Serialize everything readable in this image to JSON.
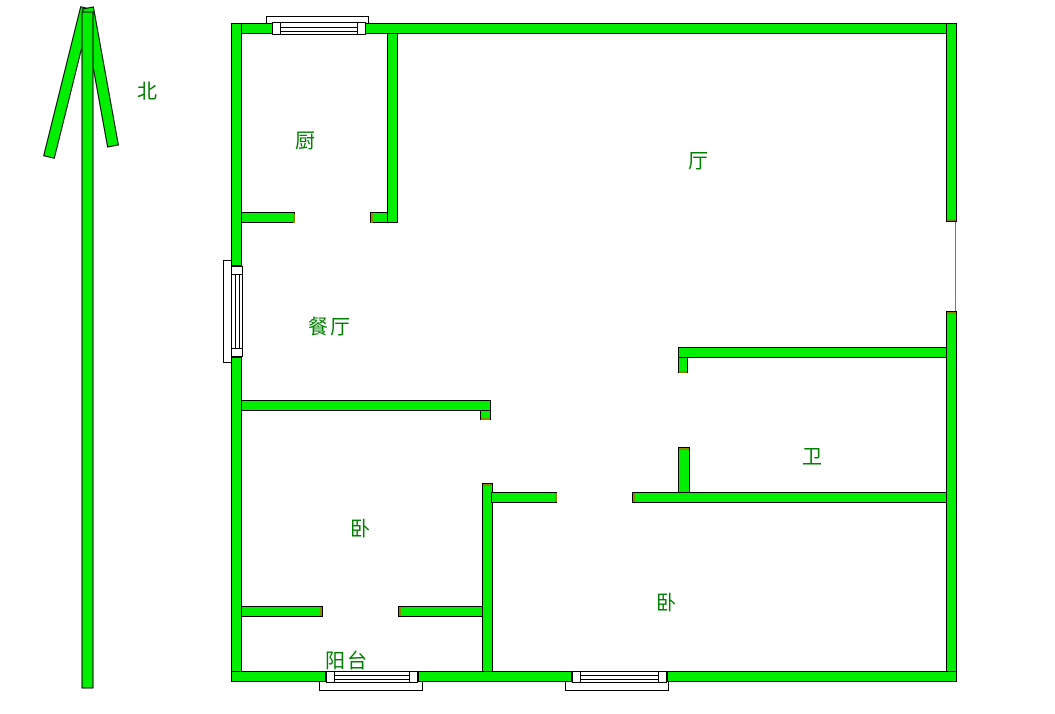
{
  "page": {
    "background": "#ffffff"
  },
  "colors": {
    "wall_fill": "#00ee00",
    "wall_outline": "#000000",
    "window_fill": "#ffffff",
    "window_outline": "#000000",
    "cut_end_accent": "#8a8a00",
    "label_color": "#008000"
  },
  "compass": {
    "label": "北"
  },
  "room_labels": [
    {
      "id": "kitchen",
      "text": "厨",
      "cx": 306,
      "cy": 139
    },
    {
      "id": "living-room",
      "text": "厅",
      "cx": 699,
      "cy": 159
    },
    {
      "id": "dining-room",
      "text": "餐厅",
      "cx": 330,
      "cy": 325
    },
    {
      "id": "bedroom-left",
      "text": "卧",
      "cx": 361,
      "cy": 527
    },
    {
      "id": "bathroom",
      "text": "卫",
      "cx": 813,
      "cy": 455
    },
    {
      "id": "bedroom-right",
      "text": "卧",
      "cx": 667,
      "cy": 601
    },
    {
      "id": "balcony",
      "text": "阳台",
      "cx": 347,
      "cy": 659
    }
  ],
  "walls": [
    {
      "id": "outer-top-west",
      "x": 231,
      "y": 23,
      "w": 42,
      "h": 11
    },
    {
      "id": "outer-top-main",
      "x": 365,
      "y": 23,
      "w": 592,
      "h": 11
    },
    {
      "id": "outer-left-upper",
      "x": 231,
      "y": 23,
      "w": 11,
      "h": 243
    },
    {
      "id": "outer-left-lower",
      "x": 231,
      "y": 357,
      "w": 11,
      "h": 325
    },
    {
      "id": "outer-right-upper",
      "x": 946,
      "y": 23,
      "w": 11,
      "h": 199
    },
    {
      "id": "outer-right-lower",
      "x": 946,
      "y": 311,
      "w": 11,
      "h": 371
    },
    {
      "id": "outer-bottom-west",
      "x": 231,
      "y": 671,
      "w": 95,
      "h": 11
    },
    {
      "id": "outer-bottom-mid",
      "x": 418,
      "y": 671,
      "w": 154,
      "h": 11
    },
    {
      "id": "outer-bottom-east",
      "x": 667,
      "y": 671,
      "w": 290,
      "h": 11
    },
    {
      "id": "kitchen-east",
      "x": 387,
      "y": 33,
      "w": 11,
      "h": 190
    },
    {
      "id": "kitchen-south-west",
      "x": 241,
      "y": 212,
      "w": 54,
      "h": 11
    },
    {
      "id": "kitchen-south-east",
      "x": 370,
      "y": 212,
      "w": 18,
      "h": 11
    },
    {
      "id": "bedroom-left-north",
      "x": 241,
      "y": 400,
      "w": 250,
      "h": 11
    },
    {
      "id": "bedroom-left-north-stub",
      "x": 480,
      "y": 410,
      "w": 11,
      "h": 10
    },
    {
      "id": "center-vertical",
      "x": 482,
      "y": 483,
      "w": 11,
      "h": 189
    },
    {
      "id": "corridor-west",
      "x": 491,
      "y": 492,
      "w": 66,
      "h": 11
    },
    {
      "id": "corridor-east",
      "x": 632,
      "y": 492,
      "w": 315,
      "h": 11
    },
    {
      "id": "bathroom-door-pier",
      "x": 678,
      "y": 447,
      "w": 12,
      "h": 46
    },
    {
      "id": "bathroom-north",
      "x": 678,
      "y": 347,
      "w": 269,
      "h": 11
    },
    {
      "id": "bathroom-north-stub",
      "x": 678,
      "y": 357,
      "w": 10,
      "h": 16
    },
    {
      "id": "bedroom-left-south-west",
      "x": 241,
      "y": 606,
      "w": 82,
      "h": 11
    },
    {
      "id": "bedroom-left-south-east",
      "x": 398,
      "y": 606,
      "w": 85,
      "h": 11
    }
  ],
  "cut_end_caps": [
    {
      "id": "cap-kitchen-south-end",
      "x": 293,
      "y": 214,
      "w": 2,
      "h": 9
    },
    {
      "id": "cap-kitchen-south-east",
      "x": 371,
      "y": 214,
      "w": 2,
      "h": 9
    },
    {
      "id": "cap-bed1-north-stub",
      "x": 481,
      "y": 418,
      "w": 9,
      "h": 2
    },
    {
      "id": "cap-center-vertical-top",
      "x": 483,
      "y": 484,
      "w": 9,
      "h": 2
    },
    {
      "id": "cap-corridor-west-end",
      "x": 555,
      "y": 493,
      "w": 2,
      "h": 9
    },
    {
      "id": "cap-corridor-east-start",
      "x": 633,
      "y": 493,
      "w": 2,
      "h": 9
    },
    {
      "id": "cap-bathroom-pier-top",
      "x": 679,
      "y": 448,
      "w": 10,
      "h": 2
    },
    {
      "id": "cap-bathroom-stub-bottom",
      "x": 679,
      "y": 371,
      "w": 8,
      "h": 2
    },
    {
      "id": "cap-right-wall-gap-top",
      "x": 947,
      "y": 219,
      "w": 9,
      "h": 2
    },
    {
      "id": "cap-right-wall-gap-bottom",
      "x": 947,
      "y": 312,
      "w": 9,
      "h": 2
    },
    {
      "id": "cap-bed1-south-west-end",
      "x": 320,
      "y": 607,
      "w": 2,
      "h": 9
    },
    {
      "id": "cap-bed1-south-east-start",
      "x": 399,
      "y": 607,
      "w": 2,
      "h": 9
    }
  ],
  "windows": {
    "rects": [
      {
        "id": "kitchen-window-sill",
        "x": 266,
        "y": 16,
        "w": 103,
        "h": 8
      },
      {
        "id": "kitchen-window-body",
        "x": 272,
        "y": 22,
        "w": 94,
        "h": 13
      },
      {
        "id": "left-window-sill",
        "x": 223,
        "y": 260,
        "w": 9,
        "h": 103
      },
      {
        "id": "left-window-body",
        "x": 231,
        "y": 266,
        "w": 12,
        "h": 91
      },
      {
        "id": "balcony-window-sill",
        "x": 319,
        "y": 681,
        "w": 104,
        "h": 10
      },
      {
        "id": "balcony-window-body",
        "x": 326,
        "y": 671,
        "w": 92,
        "h": 12
      },
      {
        "id": "bedroom-right-window-sill",
        "x": 565,
        "y": 681,
        "w": 104,
        "h": 10
      },
      {
        "id": "bedroom-right-window-body",
        "x": 572,
        "y": 671,
        "w": 95,
        "h": 12
      }
    ],
    "lines": [
      {
        "id": "kitchen-window-pane-1",
        "x": 281,
        "y": 27,
        "w": 76,
        "h": 1
      },
      {
        "id": "kitchen-window-pane-2",
        "x": 281,
        "y": 31,
        "w": 76,
        "h": 1
      },
      {
        "id": "left-window-pane-1",
        "x": 235,
        "y": 275,
        "w": 1,
        "h": 73
      },
      {
        "id": "left-window-pane-2",
        "x": 239,
        "y": 275,
        "w": 1,
        "h": 73
      },
      {
        "id": "balcony-window-pane-1",
        "x": 335,
        "y": 675,
        "w": 74,
        "h": 1
      },
      {
        "id": "balcony-window-pane-2",
        "x": 335,
        "y": 679,
        "w": 74,
        "h": 1
      },
      {
        "id": "bedroom-right-window-pane-1",
        "x": 581,
        "y": 675,
        "w": 77,
        "h": 1
      },
      {
        "id": "bedroom-right-window-pane-2",
        "x": 581,
        "y": 679,
        "w": 77,
        "h": 1
      }
    ],
    "jambs": [
      {
        "id": "kitchen-window-jamb-left",
        "x": 272,
        "y": 22,
        "w": 9,
        "h": 13
      },
      {
        "id": "kitchen-window-jamb-right",
        "x": 357,
        "y": 22,
        "w": 9,
        "h": 13
      },
      {
        "id": "left-window-jamb-top",
        "x": 231,
        "y": 266,
        "w": 12,
        "h": 9
      },
      {
        "id": "left-window-jamb-bottom",
        "x": 231,
        "y": 348,
        "w": 12,
        "h": 9
      },
      {
        "id": "balcony-window-jamb-left",
        "x": 326,
        "y": 671,
        "w": 9,
        "h": 12
      },
      {
        "id": "balcony-window-jamb-right",
        "x": 409,
        "y": 671,
        "w": 9,
        "h": 12
      },
      {
        "id": "bedroom-right-window-jamb-left",
        "x": 572,
        "y": 671,
        "w": 9,
        "h": 12
      },
      {
        "id": "bedroom-right-window-jamb-right",
        "x": 658,
        "y": 671,
        "w": 9,
        "h": 12
      }
    ]
  },
  "opening_markers": [
    {
      "id": "living-room-east-opening-line",
      "x": 955,
      "y": 222,
      "w": 1,
      "h": 89
    }
  ]
}
